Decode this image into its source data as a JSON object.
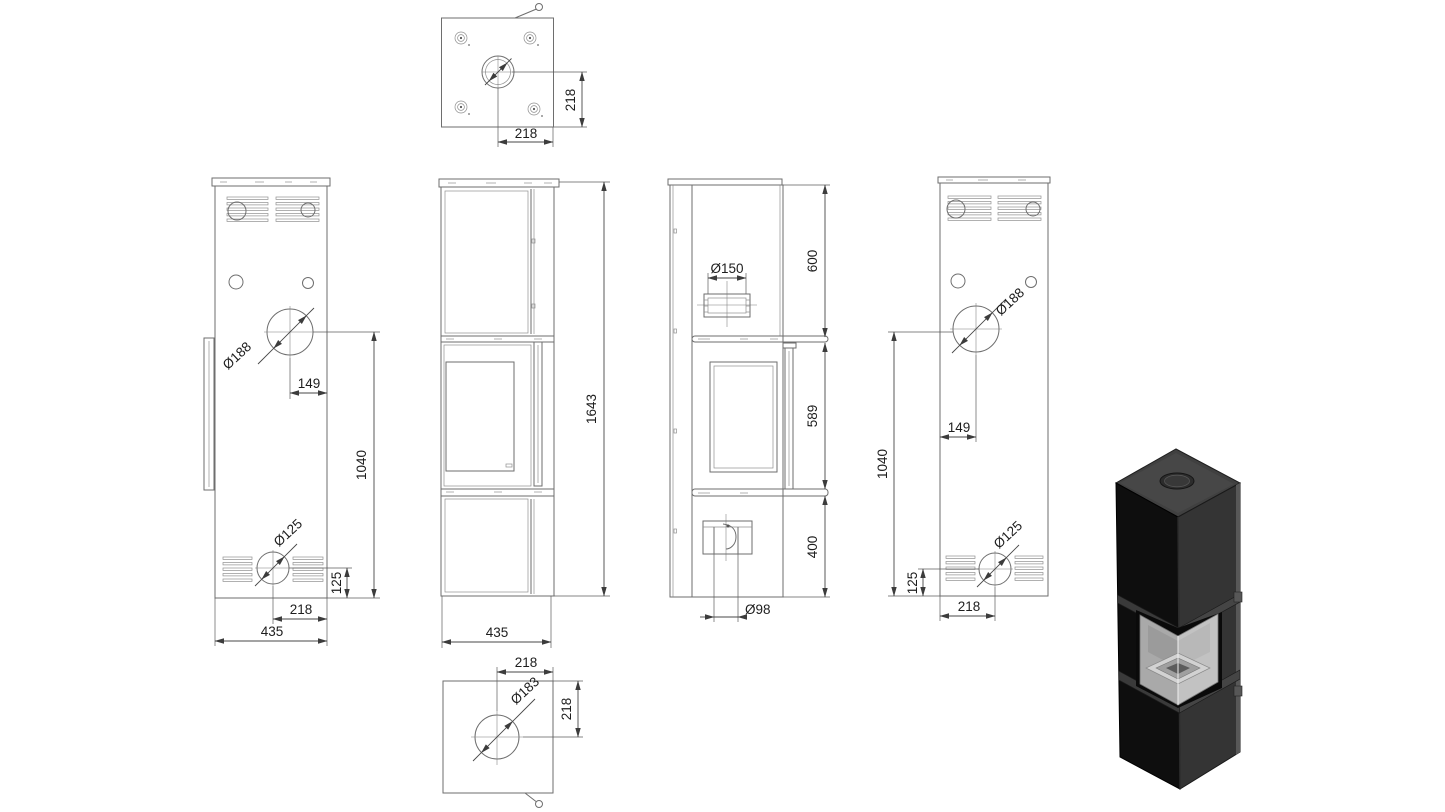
{
  "drawing": {
    "title": "Corner stove technical drawing",
    "units": "mm",
    "views": {
      "top": {
        "name": "top view",
        "dims": {
          "flue_offset_y": "218",
          "flue_offset_x": "218"
        }
      },
      "side_left": {
        "name": "left side view",
        "dims": {
          "rear_flue_diameter": "Ø188",
          "rear_flue_offset": "149",
          "rear_flue_height": "1040",
          "air_inlet_diameter": "Ø125",
          "air_inlet_height": "125",
          "air_inlet_offset": "218",
          "depth": "435"
        }
      },
      "front": {
        "name": "front view",
        "dims": {
          "total_height": "1643",
          "width": "435"
        }
      },
      "back": {
        "name": "back view",
        "dims": {
          "flue_collar_diameter": "Ø150",
          "top_module_height": "600",
          "middle_module_height": "589",
          "bottom_module_height": "400",
          "air_pipe_diameter": "Ø98"
        }
      },
      "side_right": {
        "name": "right side view",
        "dims": {
          "rear_flue_diameter": "Ø188",
          "rear_flue_offset": "149",
          "rear_flue_height": "1040",
          "air_inlet_diameter": "Ø125",
          "air_inlet_height": "125",
          "air_inlet_offset": "218"
        }
      },
      "bottom": {
        "name": "bottom view",
        "dims": {
          "outlet_offset_x": "218",
          "outlet_offset_y": "218",
          "outlet_diameter": "Ø183"
        }
      },
      "render": {
        "name": "3d product render of black corner stove"
      }
    },
    "colors": {
      "line": "#6e6e6e",
      "dim_text": "#1d1d1d",
      "render_front": "#111111",
      "render_side": "#373737",
      "render_top": "#404040",
      "render_glass": "#b5b5b5"
    }
  }
}
